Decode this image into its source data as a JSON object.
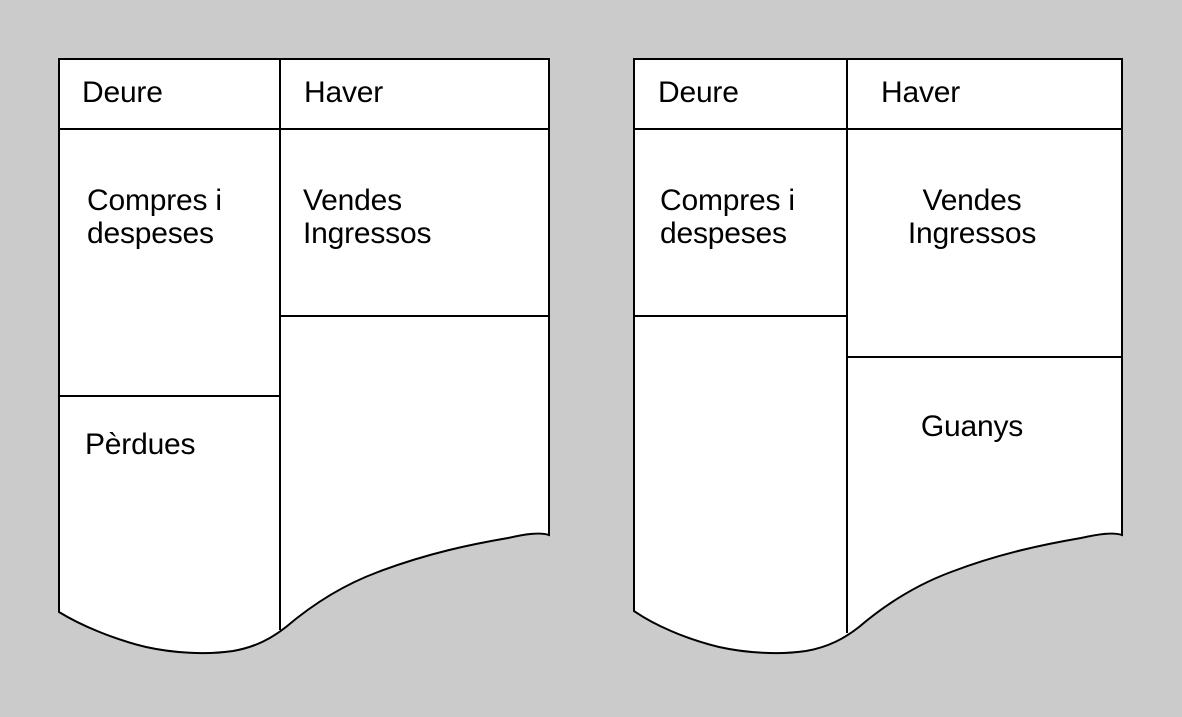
{
  "canvas": {
    "background_color": "#cbcbcb",
    "sheet_fill": "#ffffff",
    "line_color": "#000000"
  },
  "accounts": [
    {
      "id": "result-account-losses",
      "columns": {
        "debit": "Deure",
        "credit": "Haver"
      },
      "entries": {
        "debit": "Compres i\ndespeses",
        "credit": "Vendes\nIngressos"
      },
      "result": {
        "debit": "Pèrdues",
        "credit": ""
      }
    },
    {
      "id": "result-account-gains",
      "columns": {
        "debit": "Deure",
        "credit": "Haver"
      },
      "entries": {
        "debit": "Compres i\ndespeses",
        "credit": "Vendes\nIngressos"
      },
      "result": {
        "debit": "",
        "credit": "Guanys"
      }
    }
  ]
}
